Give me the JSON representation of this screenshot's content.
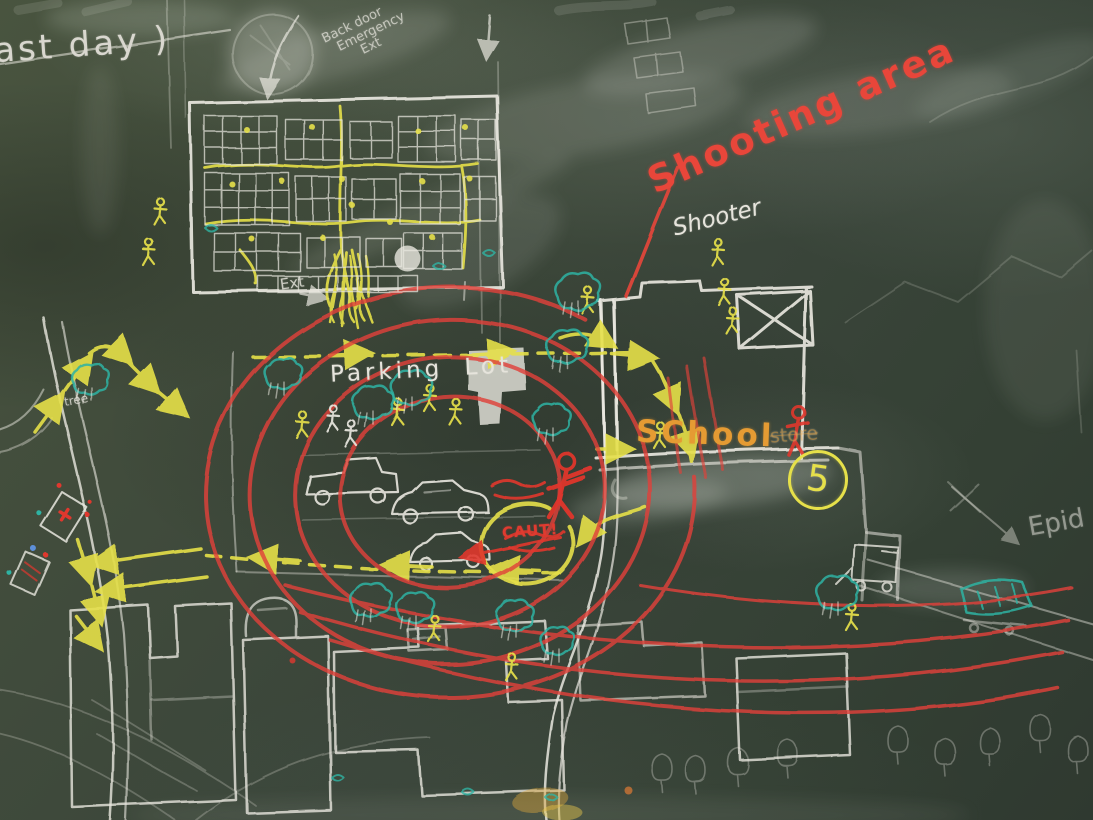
{
  "labels": {
    "last_day_note": "ast day )",
    "back_door_line1": "Back door",
    "back_door_line2": "Emergency",
    "back_door_line3": "Ext",
    "shooting_area": "Shooting area",
    "shooter": "Shooter",
    "parking_lot": "Parking Lot",
    "building_exit": "Ext",
    "school": "SChool",
    "school_faded_note": "store",
    "staging_number": "5",
    "caution": "CAUT!",
    "tree": "tree",
    "epid_partial": "Epid"
  },
  "colors": {
    "board_green": "#3d4a3c",
    "chalk_white": "#e9e7df",
    "chalk_yellow": "#e6e04a",
    "chalk_red": "#e0372e",
    "chalk_orange": "#e59b33",
    "chalk_teal": "#2fb3a3",
    "chalk_blue": "#5d8fd8"
  }
}
